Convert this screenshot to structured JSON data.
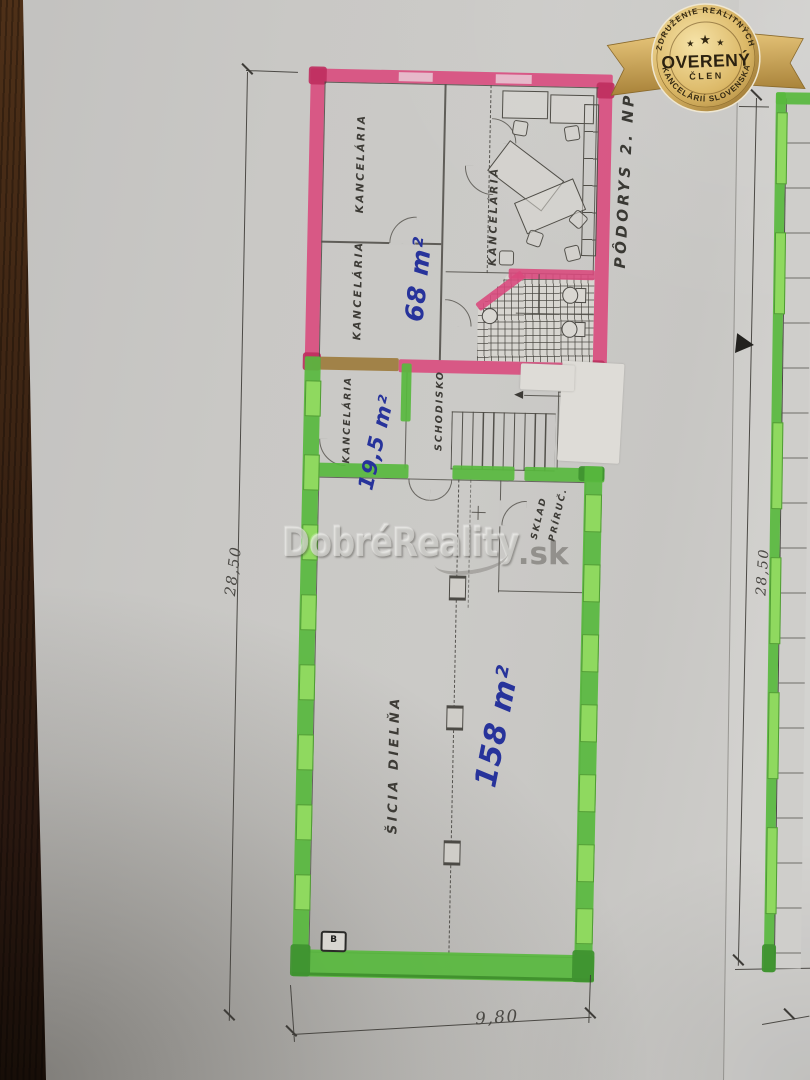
{
  "badge": {
    "arc_top": "ZDRUŽENIE REALITNÝCH",
    "title": "OVERENÝ",
    "subtitle": "ČLEN",
    "arc_bottom": "KANCELÁRIÍ SLOVENSKA",
    "star": "★",
    "gold": "#d6b263",
    "text_color": "#332812"
  },
  "watermark": {
    "brand": "DobréReality",
    "tld": ".sk"
  },
  "plan": {
    "title": "PÔDORYS 2. NP",
    "rooms": {
      "office_top_left": "KANCELÁRIA",
      "office_bottom_left": "KANCELÁRIA",
      "office_right": "KANCELÁRIA",
      "office_green": "KANCELÁRIA",
      "staircase": "SCHODISKO",
      "storage_line1": "PRÍRUČ.",
      "storage_line2": "SKLAD",
      "workshop": "ŠICIA DIELŇA"
    },
    "areas": {
      "office_block": "68 m²",
      "office_green": "19,5 m²",
      "workshop": "158 m²"
    },
    "marker_b": "B",
    "colors": {
      "highlight_pink": "#d9487c",
      "highlight_green": "#58b93e",
      "window_green": "#8fd95f",
      "pen_blue": "#27339b",
      "overlap_tan": "#9c7a3a"
    }
  },
  "dimensions": {
    "left": "28,50",
    "bottom": "9,80",
    "right_page": "28,50"
  }
}
